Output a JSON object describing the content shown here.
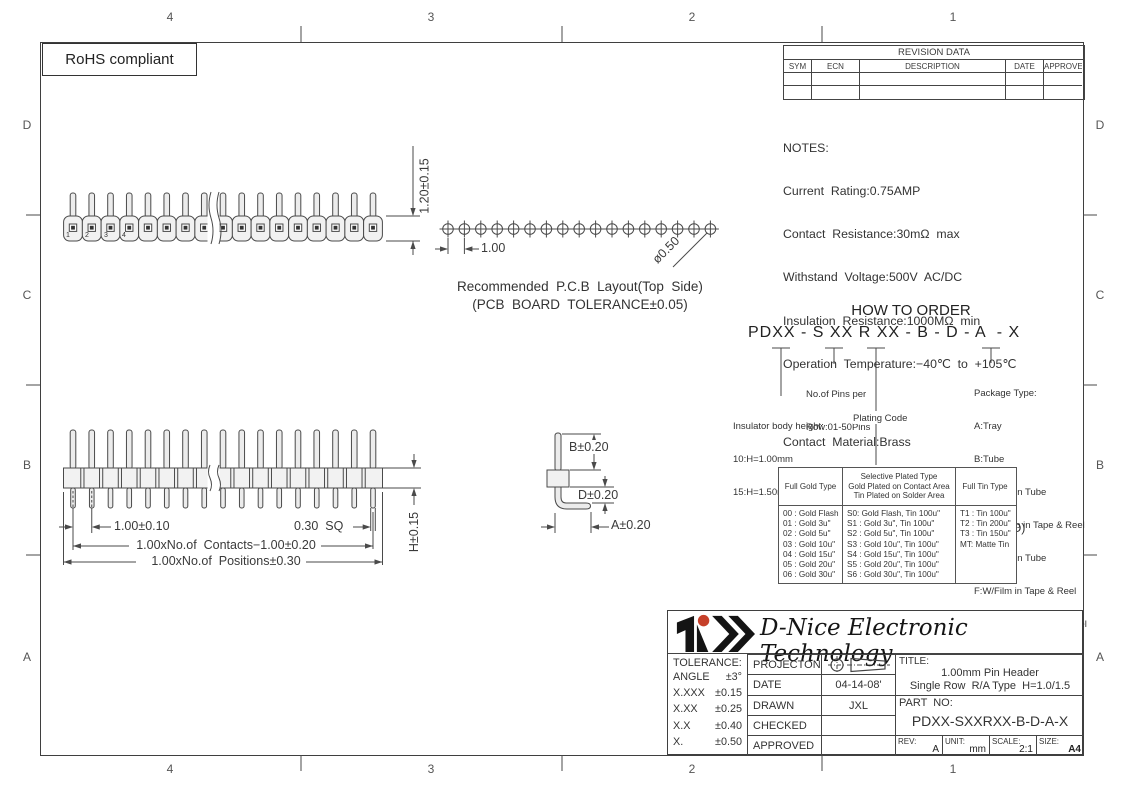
{
  "sheet": {
    "rohs_label": "RoHS compliant",
    "zones_top": [
      "4",
      "3",
      "2",
      "1"
    ],
    "zones_bottom": [
      "4",
      "3",
      "2",
      "1"
    ],
    "zones_left": [
      "D",
      "C",
      "B",
      "A"
    ],
    "zones_right": [
      "D",
      "C",
      "B",
      "A"
    ]
  },
  "revision_table": {
    "title": "REVISION  DATA",
    "headers": [
      "SYM",
      "ECN",
      "DESCRIPTION",
      "DATE",
      "APPROVED"
    ]
  },
  "notes": {
    "heading": "NOTES:",
    "electrical": [
      "Current  Rating:0.75AMP",
      "Contact  Resistance:30mΩ  max",
      "Withstand  Voltage:500V  AC/DC",
      "Insulation  Resistance:1000MΩ  min",
      "Operation  Temperature:−40℃  to  +105℃"
    ],
    "material": [
      "Contact  Material:Brass",
      "Contact  plating:Au  or  Sn  Over  Ni",
      "Insulator  Material:PA6T+30%GF(UL94V−O)"
    ]
  },
  "pcb_layout": {
    "caption_line1": "Recommended  P.C.B  Layout(Top  Side)",
    "caption_line2": "(PCB  BOARD  TOLERANCE±0.05)",
    "pitch_dim": "1.00",
    "hole_dim": "ø0.50"
  },
  "dimensions": {
    "pin_above_body": "1.20±0.15",
    "pitch": "1.00±0.10",
    "pin_square": "0.30  SQ",
    "contacts_span": "1.00xNo.of  Contacts−1.00±0.20",
    "positions_span": "1.00xNo.of  Positions±0.30",
    "body_height": "H±0.15",
    "tail_b": "B±0.20",
    "tail_d": "D±0.20",
    "tail_a": "A±0.20",
    "pin_numbers": [
      "1",
      "2",
      "3",
      "4"
    ]
  },
  "how_to_order": {
    "heading": "HOW TO ORDER",
    "part_string": "PDXX - S XX R XX - B - D - A  - X",
    "pins_per_row": [
      "No.of Pins per",
      "Row:01-50Pins"
    ],
    "insulator_height": [
      "Insulator body height:",
      "10:H=1.00mm",
      "15:H=1.50mm"
    ],
    "plating_code_label": "Plating Code",
    "package_type": [
      "Package Type:",
      "A:Tray",
      "B:Tube",
      "C:W/Cap in Tube",
      "D:W/o Cap in Tape & Reel",
      "E:W/Film in Tube",
      "F:W/Film in Tape & Reel",
      "R:With Cap in Tape & Reel",
      "G:Bag"
    ]
  },
  "plating_table": {
    "gold_header": "Full Gold Type",
    "selective_header": [
      "Selective Plated Type",
      "Gold Plated on Contact Area",
      "Tin Plated on Solder Area"
    ],
    "tin_header": "Full Tin Type",
    "gold": [
      "00 : Gold Flash",
      "01 : Gold 3u\"",
      "02 : Gold 5u\"",
      "03 : Gold 10u\"",
      "04 : Gold 15u\"",
      "05 : Gold 20u\"",
      "06 : Gold 30u\""
    ],
    "selective": [
      "S0: Gold Flash, Tin 100u\"",
      "S1 : Gold 3u\",  Tin 100u\"",
      "S2 : Gold 5u\",  Tin 100u\"",
      "S3 : Gold 10u\", Tin 100u\"",
      "S4 : Gold 15u\", Tin 100u\"",
      "S5 : Gold 20u\", Tin 100u\"",
      "S6 : Gold 30u\", Tin 100u\""
    ],
    "tin": [
      "T1 : Tin 100u\"",
      "T2 : Tin 200u\"",
      "T3 : Tin 150u\"",
      "MT: Matte Tin"
    ]
  },
  "title_block": {
    "company": "D-Nice Electronic Technology",
    "tolerance_heading": "TOLERANCE:",
    "tolerance": [
      {
        "l": "ANGLE",
        "v": "±3°"
      },
      {
        "l": "X.XXX",
        "v": "±0.15"
      },
      {
        "l": "X.XX",
        "v": "±0.25"
      },
      {
        "l": "X.X",
        "v": "±0.40"
      },
      {
        "l": "X.",
        "v": "±0.50"
      }
    ],
    "projection_label": "PROJECTON",
    "date_label": "DATE",
    "date_value": "04-14-08'",
    "drawn_label": "DRAWN",
    "drawn_value": "JXL",
    "checked_label": "CHECKED",
    "approved_label": "APPROVED",
    "title_label": "TITLE:",
    "title_line1": "1.00mm Pin Header",
    "title_line2": "Single Row  R/A Type  H=1.0/1.5",
    "part_no_label": "PART  NO:",
    "part_no_value": "PDXX-SXXRXX-B-D-A-X",
    "rev_label": "REV:",
    "rev_value": "A",
    "unit_label": "UNIT:",
    "unit_value": "mm",
    "scale_label": "SCALE:",
    "scale_value": "2:1",
    "size_label": "SIZE:",
    "size_value": "A4"
  }
}
